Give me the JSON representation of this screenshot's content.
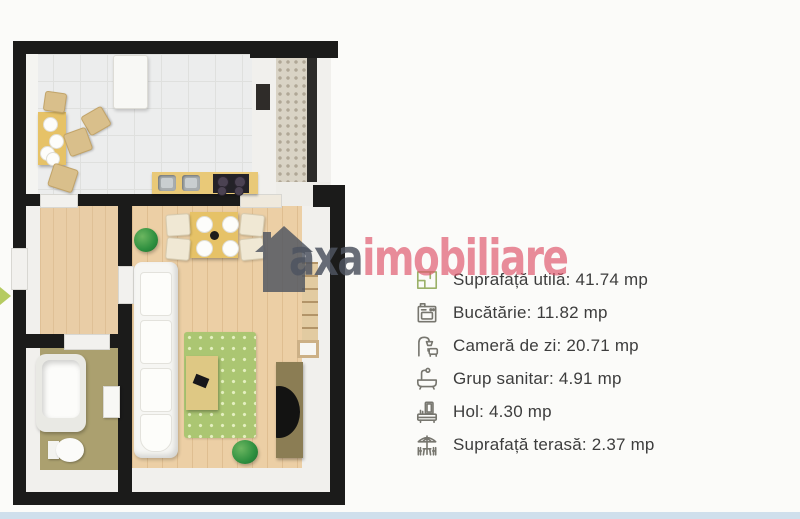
{
  "brand": {
    "watermark_gray_text": "axa",
    "watermark_pink_text": "imobiliare",
    "gray_color": "#4e5460",
    "pink_color": "#df566b",
    "house_icon": "house-silhouette-icon"
  },
  "legend": {
    "text_color": "#3d3d3d",
    "items": [
      {
        "icon": "floorplan-icon",
        "label": "Suprafață utilă:",
        "value": "41.74 mp"
      },
      {
        "icon": "stove-icon",
        "label": "Bucătărie:",
        "value": "11.82 mp"
      },
      {
        "icon": "lamp-armchair-icon",
        "label": "Cameră de zi:",
        "value": "20.71 mp"
      },
      {
        "icon": "bathtub-icon",
        "label": "Grup sanitar:",
        "value": "4.91 mp"
      },
      {
        "icon": "dresser-mirror-icon",
        "label": "Hol:",
        "value": "4.30 mp"
      },
      {
        "icon": "terrace-umbrella-icon",
        "label": "Suprafață terasă:",
        "value": "2.37 mp"
      }
    ]
  },
  "floorplan": {
    "colors": {
      "wall": "#1b1b1a",
      "kitchen_tile": "#eceded",
      "wood_floor": "#eccfa5",
      "bathroom_floor": "#aba06f",
      "terrace_floor": "#d9d3c5",
      "rug_green": "#abc672",
      "table_yellow": "#e6c267"
    }
  },
  "page": {
    "background": "#fbfbf9",
    "bottom_strip_color": "#cfdfec"
  }
}
